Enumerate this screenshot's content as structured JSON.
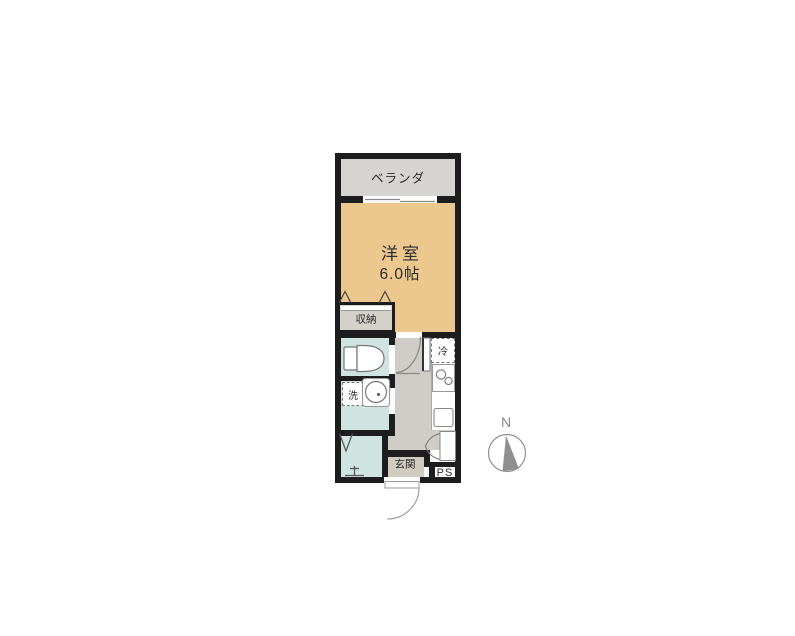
{
  "floorplan": {
    "rooms": {
      "balcony": {
        "label": "ベランダ"
      },
      "western_room": {
        "label": "洋室",
        "size": "6.0帖"
      },
      "closet": {
        "label": "収納"
      },
      "refrigerator": {
        "label": "冷"
      },
      "washer": {
        "label": "洗"
      },
      "entrance": {
        "label": "玄関"
      },
      "pipe_space": {
        "label": "PS"
      }
    },
    "compass": {
      "label": "N"
    },
    "colors": {
      "wall": "#1d1d1d",
      "room_floor": "#edc88e",
      "balcony_floor": "#d5d4d1",
      "closet_floor": "#d4d1cb",
      "wet_area_floor": "#cfe3e1",
      "hallway_floor": "#cfcdc5",
      "entrance_floor": "#d1ccc0",
      "fixture_outline": "#777777",
      "compass": "#8a8a8a"
    }
  }
}
